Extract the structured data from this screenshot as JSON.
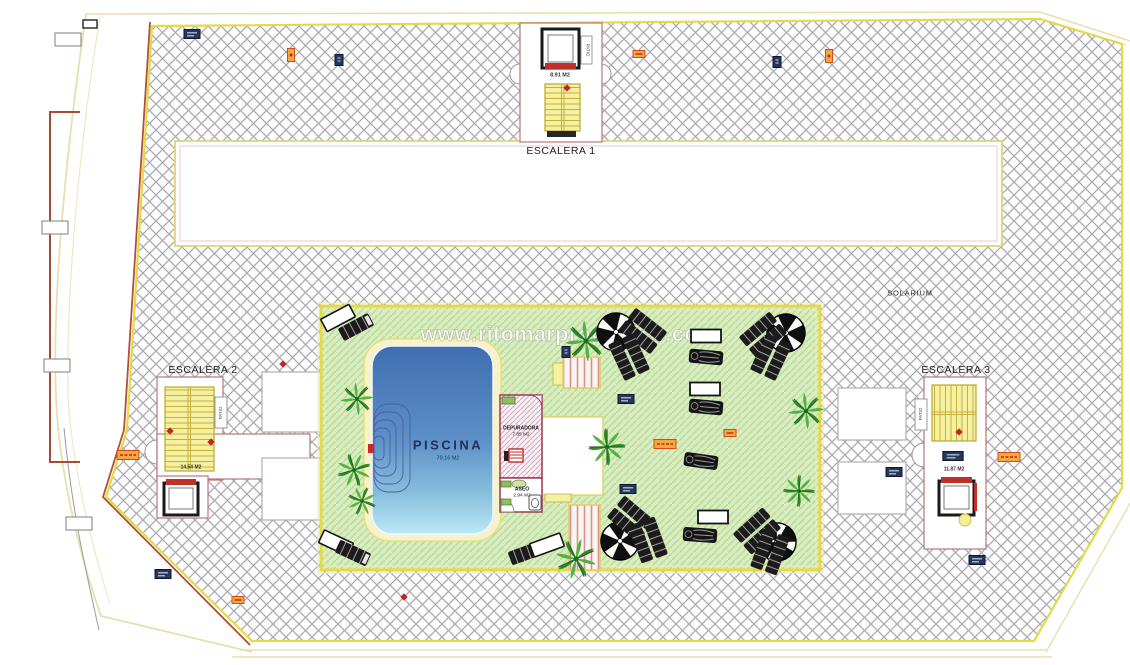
{
  "plan": {
    "watermark": "www.ritomarproperties.com",
    "solarium_label": "SOLARIUM",
    "escalera1": {
      "label": "ESCALERA 1",
      "area": "8.91 M2",
      "shaft": "PATIO"
    },
    "escalera2": {
      "label": "ESCALERA 2",
      "area": "14.54 M2",
      "shaft": "PATIO"
    },
    "escalera3": {
      "label": "ESCALERA 3",
      "area": "11.87 M2",
      "shaft": "PATIO"
    },
    "piscina": {
      "label": "PISCINA",
      "area": "70.16 M2"
    },
    "depuradora": {
      "label": "DEPURADORA",
      "area": "7.85 M2"
    },
    "aseo": {
      "label": "ASEO",
      "area": "2.94 M2"
    },
    "colors": {
      "boundary_yellow": "#e2da48",
      "hatch_line": "#a8a8b1",
      "green_fill": "#d9edc0",
      "green_line": "#b9da9b",
      "pool_top": "#3e6eb0",
      "pool_bottom": "#bce8f5",
      "stair_yellow": "#f6f0a3",
      "accent_red": "#c62222",
      "wall_maroon": "#b87878",
      "tag_orange": "#f4a93e",
      "tag_navy": "#26365c"
    }
  }
}
